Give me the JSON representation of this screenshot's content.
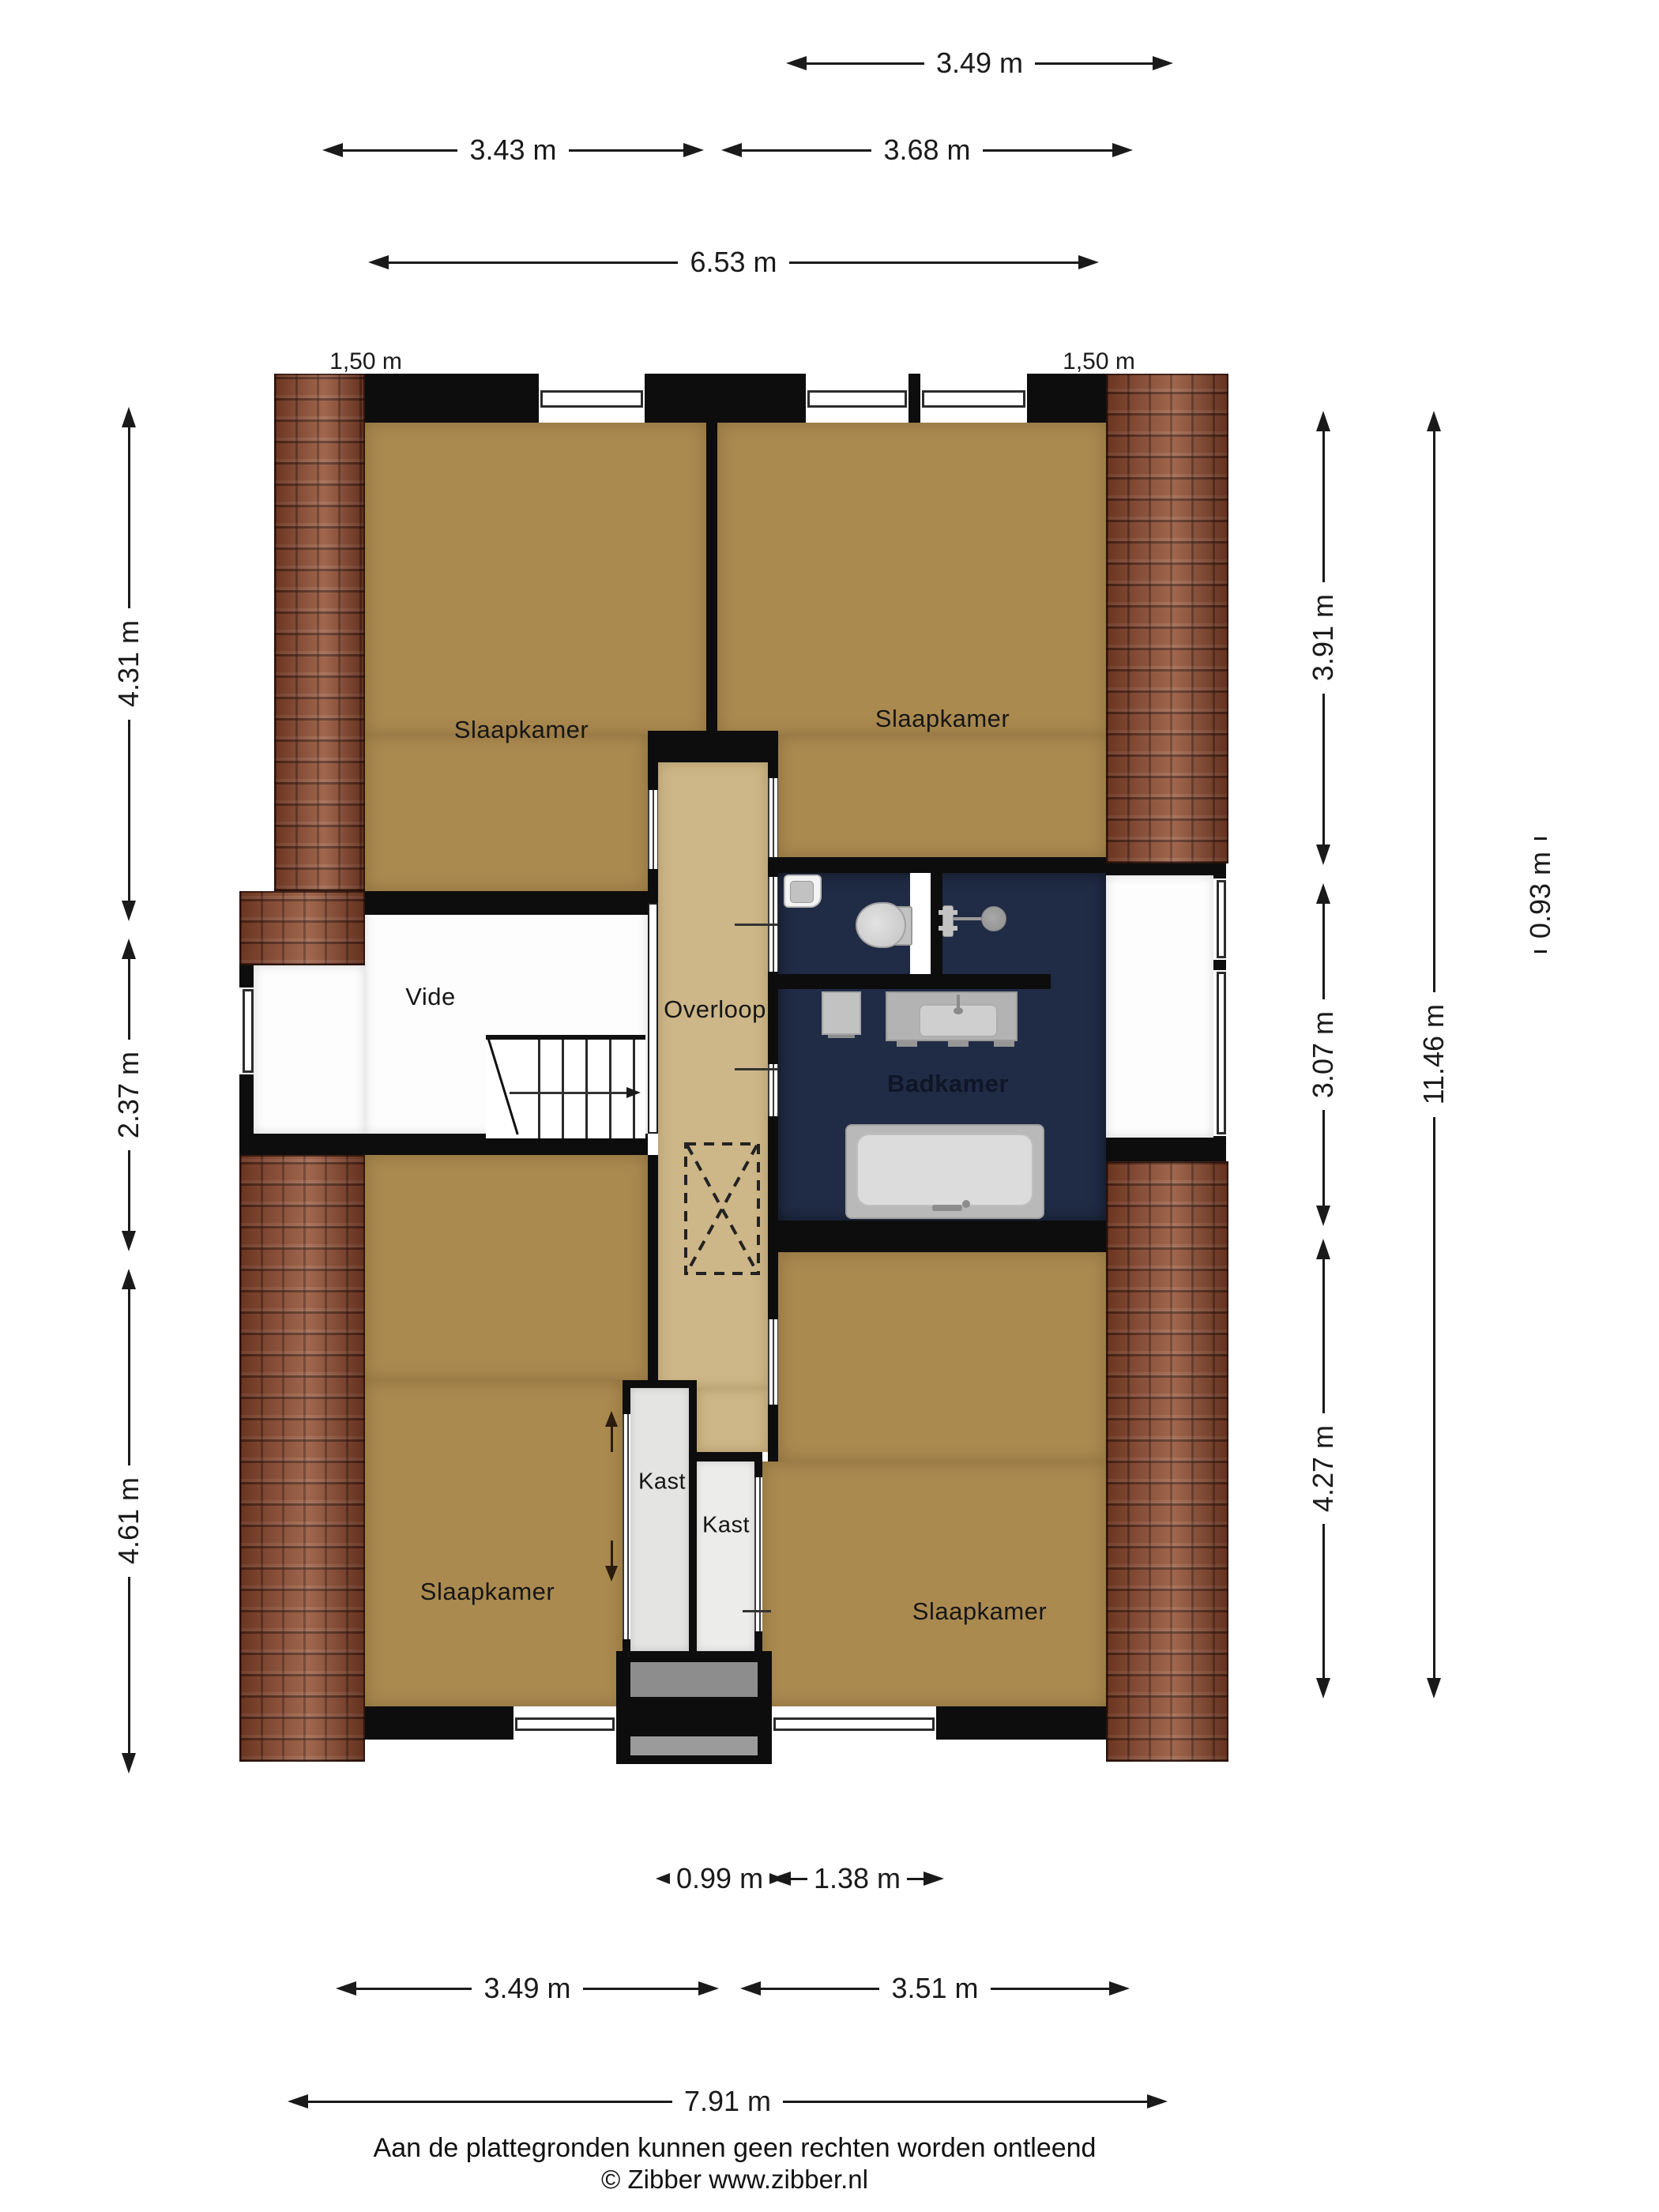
{
  "rooms": {
    "slaapkamer_tl": "Slaapkamer",
    "slaapkamer_tr": "Slaapkamer",
    "slaapkamer_bl": "Slaapkamer",
    "slaapkamer_br": "Slaapkamer",
    "vide": "Vide",
    "overloop": "Overloop",
    "badkamer": "Badkamer",
    "kast_left": "Kast",
    "kast_right": "Kast"
  },
  "dims": {
    "top_w_right_bedroom": "3.49 m",
    "top_w_left": "3.43 m",
    "top_w_right": "3.68 m",
    "top_w_total": "6.53 m",
    "eave_left": "1,50 m",
    "eave_right": "1,50 m",
    "left_h_top": "4.31 m",
    "left_h_mid": "2.37 m",
    "left_h_bottom": "4.61 m",
    "right_h_top": "3.91 m",
    "right_h_mid": "3.07 m",
    "right_h_bottom": "4.27 m",
    "right_h_total": "11.46 m",
    "right_w_eave": "0.93 m",
    "bottom_w_closet": "0.99 m",
    "bottom_w_entry": "1.38 m",
    "bottom_w_left": "3.49 m",
    "bottom_w_right": "3.51 m",
    "bottom_w_total": "7.91 m"
  },
  "footer": {
    "disclaimer": "Aan de plattegronden kunnen geen rechten worden ontleend",
    "copyright": "© Zibber www.zibber.nl"
  },
  "colors": {
    "wall": "#0d0d0d",
    "dim": "#1a1a1a",
    "room_floor": "#ab8a50",
    "landing_floor": "#cdb687",
    "bathroom_floor": "#202b45",
    "closet_floor_left": "#e4e4e2",
    "closet_floor_right": "#ececea",
    "vide_floor": "#fdfdfd",
    "brick": "#8c4b31",
    "fixture_gray": "#c2c2c2",
    "entry_step_gray": "#8d8d8d"
  }
}
